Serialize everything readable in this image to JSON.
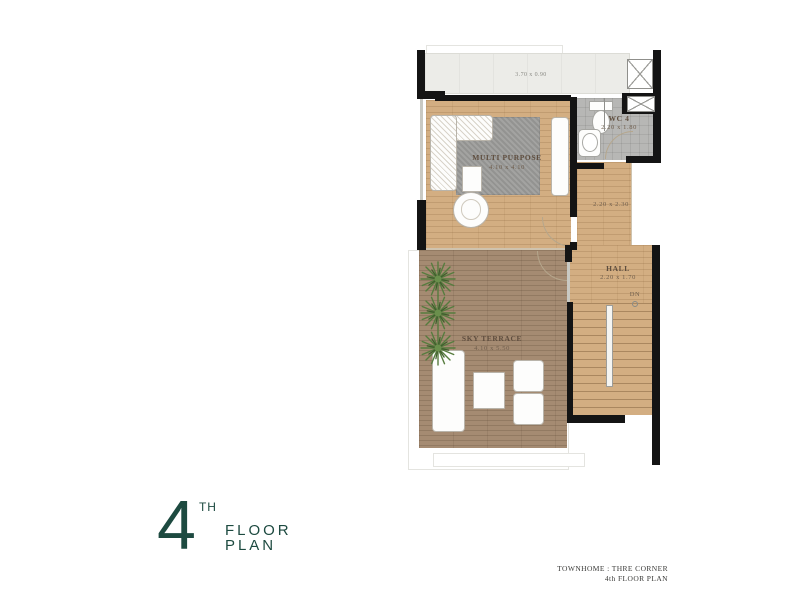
{
  "title_block": {
    "number": "4",
    "ordinal": "TH",
    "word1": "FLOOR",
    "word2": "PLAN"
  },
  "footer": {
    "project": "TOWNHOME : THRE CORNER",
    "sheet": "4th FLOOR PLAN"
  },
  "plan": {
    "balcony": {
      "dim": "3.70 x 0.90"
    },
    "multi_purpose": {
      "name": "MULTI PURPOSE",
      "dim": "4.10 x 4.10"
    },
    "wc": {
      "name": "WC 4",
      "dim": "2.20 x 1.80"
    },
    "corridor": {
      "dim": "2.20 x 2.30"
    },
    "hall": {
      "name": "HALL",
      "dim": "2.20 x 1.70"
    },
    "stairs": {
      "direction_label": "DN"
    },
    "sky_terrace": {
      "name": "SKY TERRACE",
      "dim": "4.10 x 5.50"
    }
  },
  "colors": {
    "accent_teal": "#1d4a40",
    "wall": "#141414",
    "wood_floor": "#d3ae82",
    "terrace_deck": "#a58b72",
    "wc_tile": "#b7b7b5",
    "rug": "#9c9c9a",
    "balcony_floor": "#ecece8"
  }
}
